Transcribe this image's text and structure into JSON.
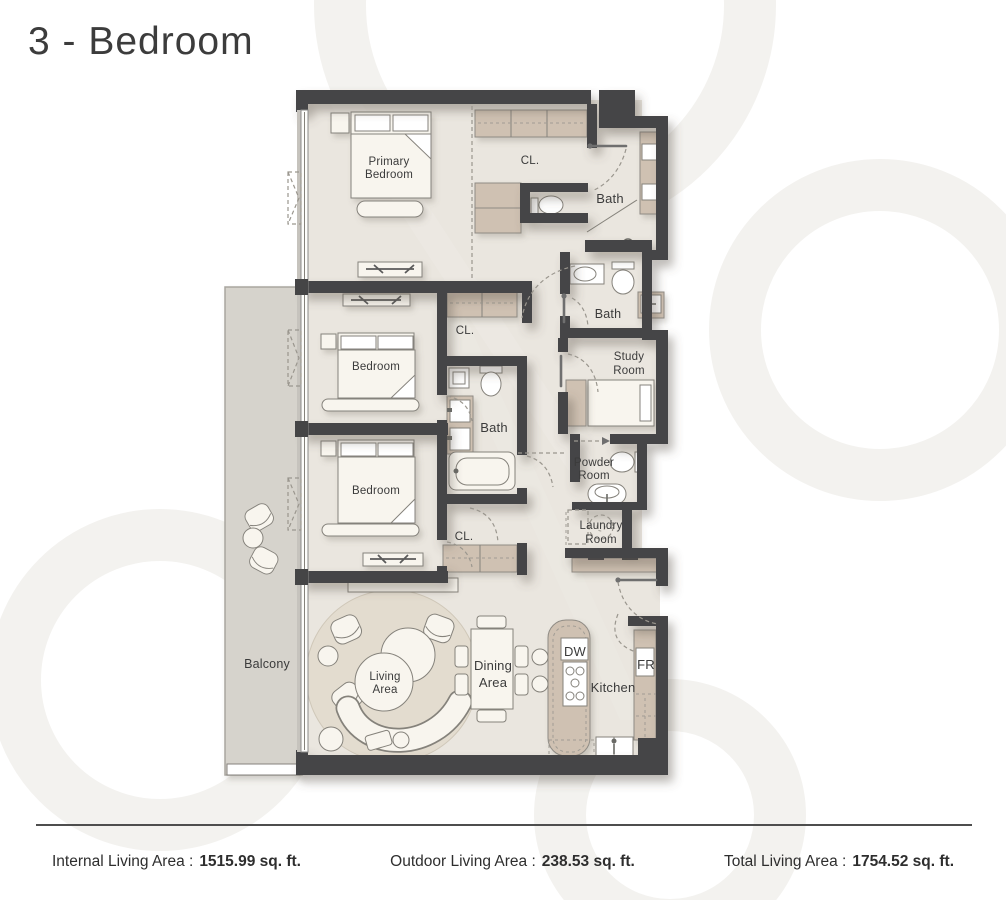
{
  "page": {
    "title": "3 - Bedroom"
  },
  "plan": {
    "labels": {
      "primary_bedroom": [
        "Primary",
        "Bedroom"
      ],
      "closet_primary": "CL.",
      "bath_primary": "Bath",
      "bath_guest": "Bath",
      "bath_middle": "Bath",
      "study_room": [
        "Study",
        "Room"
      ],
      "bedroom_2": "Bedroom",
      "closet_2": "CL.",
      "bedroom_3": "Bedroom",
      "closet_3": "CL.",
      "powder_room": [
        "Powder",
        "Room"
      ],
      "laundry_room": [
        "Laundry",
        "Room"
      ],
      "balcony": "Balcony",
      "living_area": [
        "Living",
        "Area"
      ],
      "dining_area": [
        "Dining",
        "Area"
      ],
      "kitchen": "Kitchen",
      "dishwasher": "DW",
      "fridge": "FR"
    },
    "colors": {
      "wall": "#454546",
      "floor": "#eae6df",
      "wardrobe": "#cfc1b2",
      "balcony_floor": "#d6d3cc",
      "furniture": "#f8f5ee"
    }
  },
  "footer": {
    "stats": [
      {
        "label": "Internal Living Area :",
        "value": "1515.99 sq. ft."
      },
      {
        "label": "Outdoor Living Area :",
        "value": "238.53 sq. ft."
      },
      {
        "label": "Total Living Area :",
        "value": "1754.52 sq. ft."
      }
    ]
  }
}
